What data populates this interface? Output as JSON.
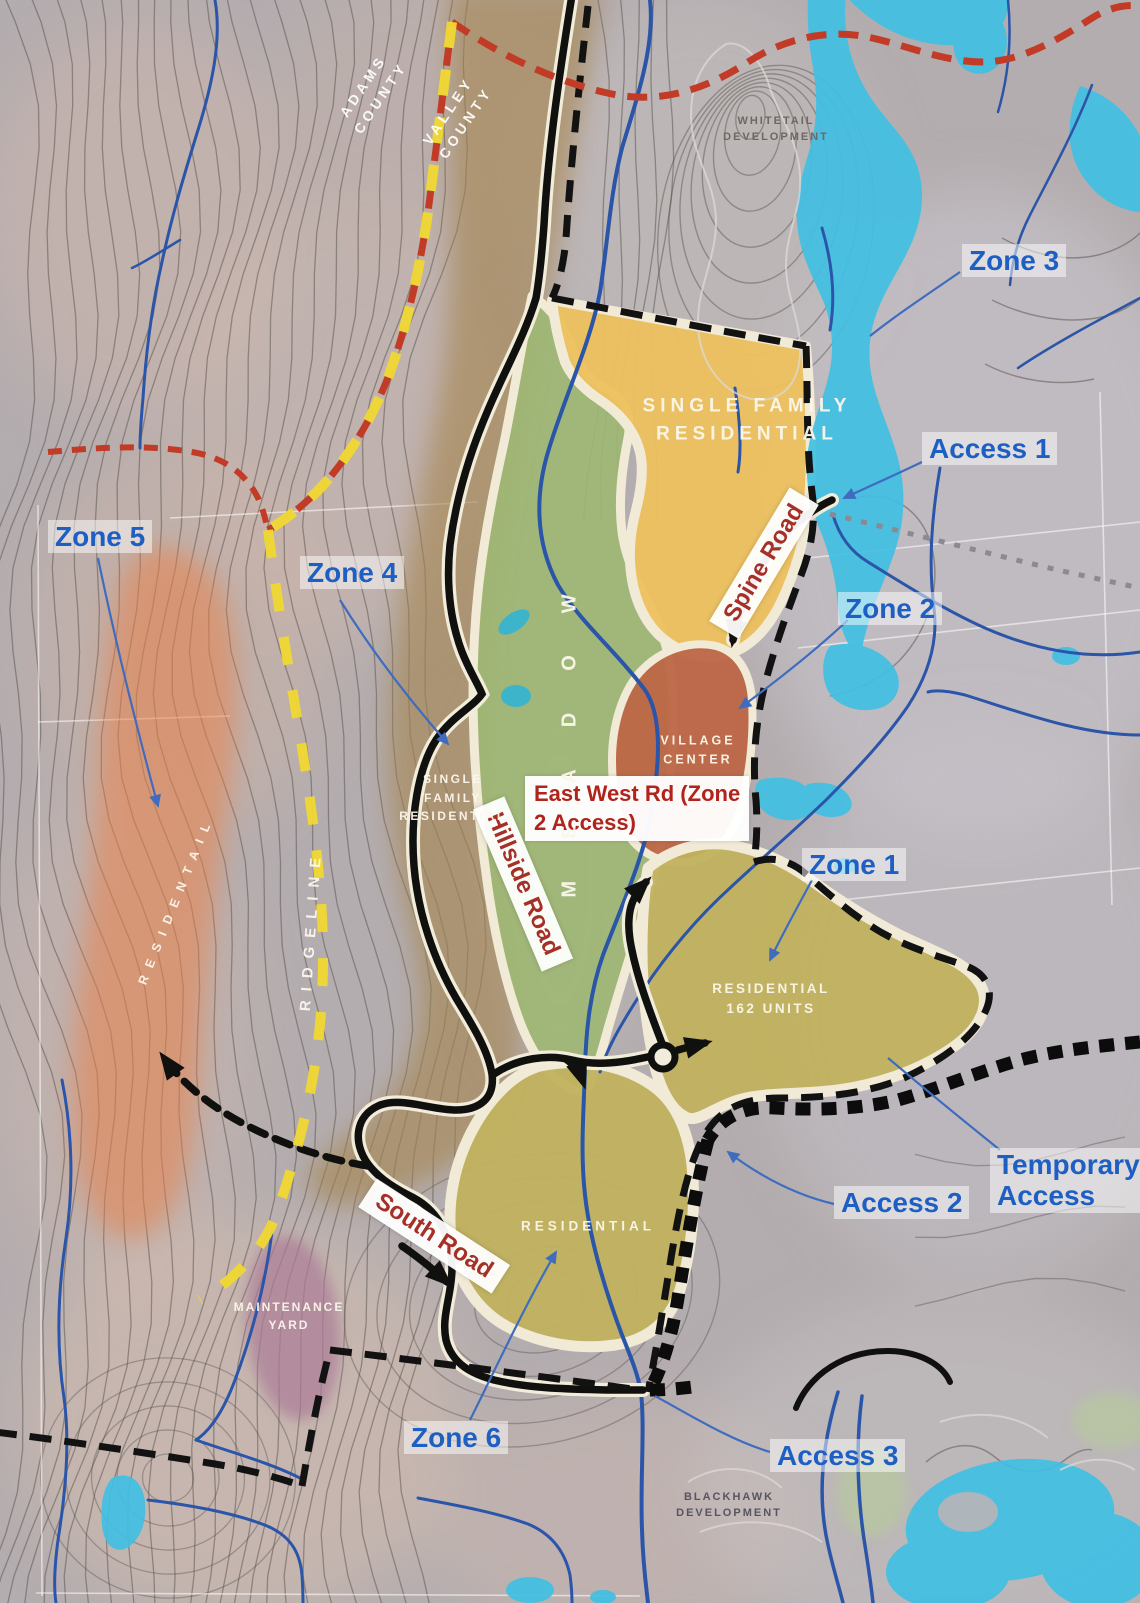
{
  "counties": {
    "adams": {
      "line1": "ADAMS",
      "line2": "COUNTY"
    },
    "valley": {
      "line1": "VALLEY",
      "line2": "COUNTY"
    }
  },
  "developments": {
    "whitetail": {
      "line1": "WHITETAIL",
      "line2": "DEVELOPMENT"
    },
    "blackhawk": {
      "line1": "BLACKHAWK",
      "line2": "DEVELOPMENT"
    }
  },
  "callouts": {
    "zone1": "Zone 1",
    "zone2": "Zone 2",
    "zone3": "Zone 3",
    "zone4": "Zone 4",
    "zone5": "Zone 5",
    "zone6": "Zone 6",
    "access1": "Access 1",
    "access2": "Access 2",
    "access3": "Access 3",
    "temporary_access": {
      "line1": "Temporary",
      "line2": "Access"
    }
  },
  "roads": {
    "spine": "Spine Road",
    "hillside": "Hillside Road",
    "south": "South Road",
    "east_west": {
      "line1": "East West Rd (Zone",
      "line2": "2 Access)"
    }
  },
  "areas": {
    "single_family_residential_zone3": {
      "line1": "SINGLE FAMILY",
      "line2": "RESIDENTIAL"
    },
    "single_family_residential_hillside": {
      "line1": "SINGLE",
      "line2": "FAMILY",
      "line3": "RESIDENTIAL"
    },
    "village_center": {
      "line1": "VILLAGE",
      "line2": "CENTER"
    },
    "residential_162_units": {
      "line1": "RESIDENTIAL",
      "line2": "162 UNITS"
    },
    "residential_south": "RESIDENTIAL",
    "residential_west": "RESIDENTAIL",
    "maintenance_yard": {
      "line1": "MAINTENANCE",
      "line2": "YARD"
    },
    "meadow": "MEADOW",
    "ridgeline": "RIDGELINE"
  },
  "colors": {
    "callout_blue": "#1d5fc2",
    "road_label_red": "#a53028",
    "east_west_red": "#b1231d",
    "zone_yellow": "#edc15e",
    "meadow_green": "#9eb873",
    "village_terracotta": "#bd6646",
    "residential_olive": "#c1b25e",
    "residential_orange": "#e8824b",
    "maintenance_purple": "#ab7b97",
    "water_cyan": "#41bfe3",
    "stream_blue": "#2b55a8",
    "county_line_red": "#c23b27",
    "ridgeline_yellow": "#f1d832"
  }
}
